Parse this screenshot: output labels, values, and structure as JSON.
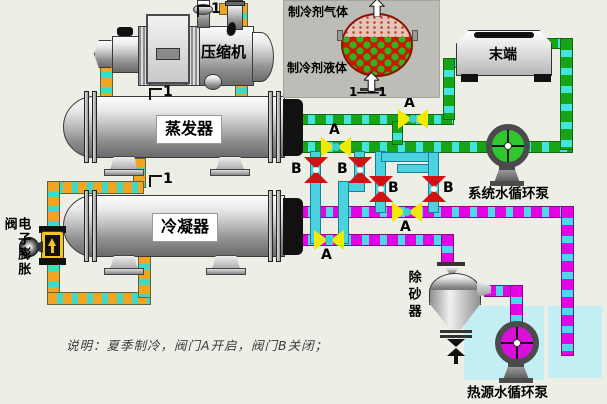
{
  "colors": {
    "background": "#edeee6",
    "pipe_orange": "#f2a51e",
    "pipe_green": "#17a517",
    "pipe_magenta": "#e403e4",
    "pipe_cyan_dash": "#43e3df",
    "pipe_cyan_solid": "#4ad2e0",
    "valve_a_open": "#f2ea00",
    "valve_b_closed": "#d21212",
    "tank": "#c2eef4",
    "system_pump_face": "#2ec82e",
    "heat_pump_face": "#da10da",
    "inset_bg": "#bdbdb7",
    "vessel_liquid": "#cc1705",
    "vessel_gas": "#e5c4ba"
  },
  "inset": {
    "gas_label": "制冷剂气体",
    "liquid_label": "制冷剂液体",
    "section_label": "1——1"
  },
  "equipment": {
    "compressor": "压缩机",
    "evaporator": "蒸发器",
    "condenser": "冷凝器",
    "terminal": "末端",
    "system_pump": "系统水循环泵",
    "heat_source_pump": "热源水循环泵",
    "sand_remover": "除砂器",
    "expansion_valve": "电子膨胀阀"
  },
  "valves": {
    "a": "A",
    "b": "B"
  },
  "markers": {
    "one": "1"
  },
  "caption": "说明：夏季制冷，阀门A开启，阀门B关闭；"
}
